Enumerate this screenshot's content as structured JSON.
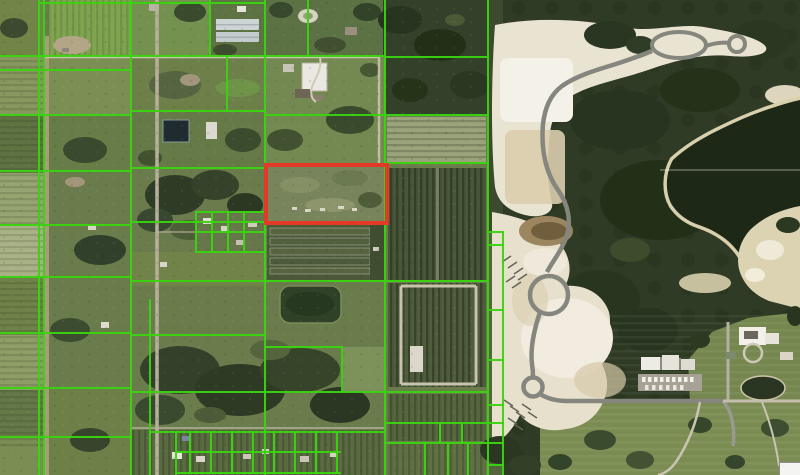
{
  "map": {
    "type": "aerial-parcel-map",
    "colors": {
      "parcel_line": "#3bd40f",
      "highlight_stroke": "#e23a27",
      "water": "#1d2817",
      "sand": "#e9e3d1",
      "forest": "#2f3b25",
      "field": "#6a7c4c",
      "construction_road": "#85867d"
    },
    "highlight_parcel": {
      "x": 266,
      "y": 165,
      "width": 121,
      "height": 58,
      "stroke_width": 4
    },
    "parcel_lines": {
      "stroke_width": 2,
      "opacity": 0.95,
      "segments": [
        [
          39,
          0,
          39,
          475
        ],
        [
          44,
          0,
          44,
          475
        ],
        [
          131,
          0,
          131,
          475
        ],
        [
          265,
          0,
          265,
          475
        ],
        [
          385,
          0,
          385,
          475
        ],
        [
          488,
          0,
          488,
          475
        ],
        [
          503,
          232,
          503,
          475
        ],
        [
          210,
          0,
          210,
          56
        ],
        [
          308,
          0,
          308,
          56
        ],
        [
          227,
          56,
          227,
          111
        ],
        [
          150,
          300,
          150,
          475
        ],
        [
          176,
          432,
          176,
          475
        ],
        [
          196,
          212,
          196,
          252
        ],
        [
          212,
          212,
          212,
          252
        ],
        [
          228,
          212,
          228,
          252
        ],
        [
          244,
          212,
          244,
          252
        ],
        [
          342,
          347,
          342,
          392
        ],
        [
          190,
          432,
          190,
          473
        ],
        [
          211,
          432,
          211,
          473
        ],
        [
          232,
          432,
          232,
          473
        ],
        [
          253,
          432,
          253,
          473
        ],
        [
          274,
          432,
          274,
          473
        ],
        [
          295,
          432,
          295,
          473
        ],
        [
          316,
          432,
          316,
          473
        ],
        [
          337,
          432,
          337,
          473
        ],
        [
          425,
          443,
          425,
          475
        ],
        [
          448,
          443,
          448,
          475
        ],
        [
          468,
          443,
          468,
          475
        ],
        [
          440,
          423,
          440,
          443
        ],
        [
          462,
          423,
          462,
          443
        ],
        [
          40,
          3,
          265,
          3
        ],
        [
          0,
          56,
          385,
          56
        ],
        [
          385,
          57,
          488,
          57
        ],
        [
          0,
          70,
          131,
          70
        ],
        [
          0,
          115,
          131,
          115
        ],
        [
          131,
          111,
          265,
          111
        ],
        [
          265,
          115,
          488,
          115
        ],
        [
          0,
          171,
          131,
          171
        ],
        [
          131,
          168,
          265,
          168
        ],
        [
          385,
          163,
          488,
          163
        ],
        [
          0,
          225,
          131,
          225
        ],
        [
          131,
          222,
          265,
          222
        ],
        [
          196,
          212,
          265,
          212
        ],
        [
          196,
          232,
          265,
          232
        ],
        [
          196,
          252,
          265,
          252
        ],
        [
          0,
          277,
          131,
          277
        ],
        [
          131,
          281,
          488,
          281
        ],
        [
          0,
          333,
          131,
          333
        ],
        [
          131,
          335,
          265,
          335
        ],
        [
          265,
          347,
          342,
          347
        ],
        [
          0,
          388,
          131,
          388
        ],
        [
          131,
          392,
          488,
          392
        ],
        [
          0,
          437,
          131,
          437
        ],
        [
          150,
          432,
          385,
          432
        ],
        [
          176,
          452,
          340,
          452
        ],
        [
          176,
          473,
          340,
          473
        ],
        [
          385,
          423,
          503,
          423
        ],
        [
          385,
          443,
          503,
          443
        ],
        [
          488,
          232,
          503,
          232
        ],
        [
          488,
          245,
          503,
          245
        ],
        [
          488,
          310,
          503,
          310
        ],
        [
          488,
          360,
          503,
          360
        ],
        [
          488,
          405,
          503,
          405
        ],
        [
          488,
          465,
          503,
          465
        ]
      ]
    },
    "controls": {
      "partial_button_visible": true
    }
  }
}
